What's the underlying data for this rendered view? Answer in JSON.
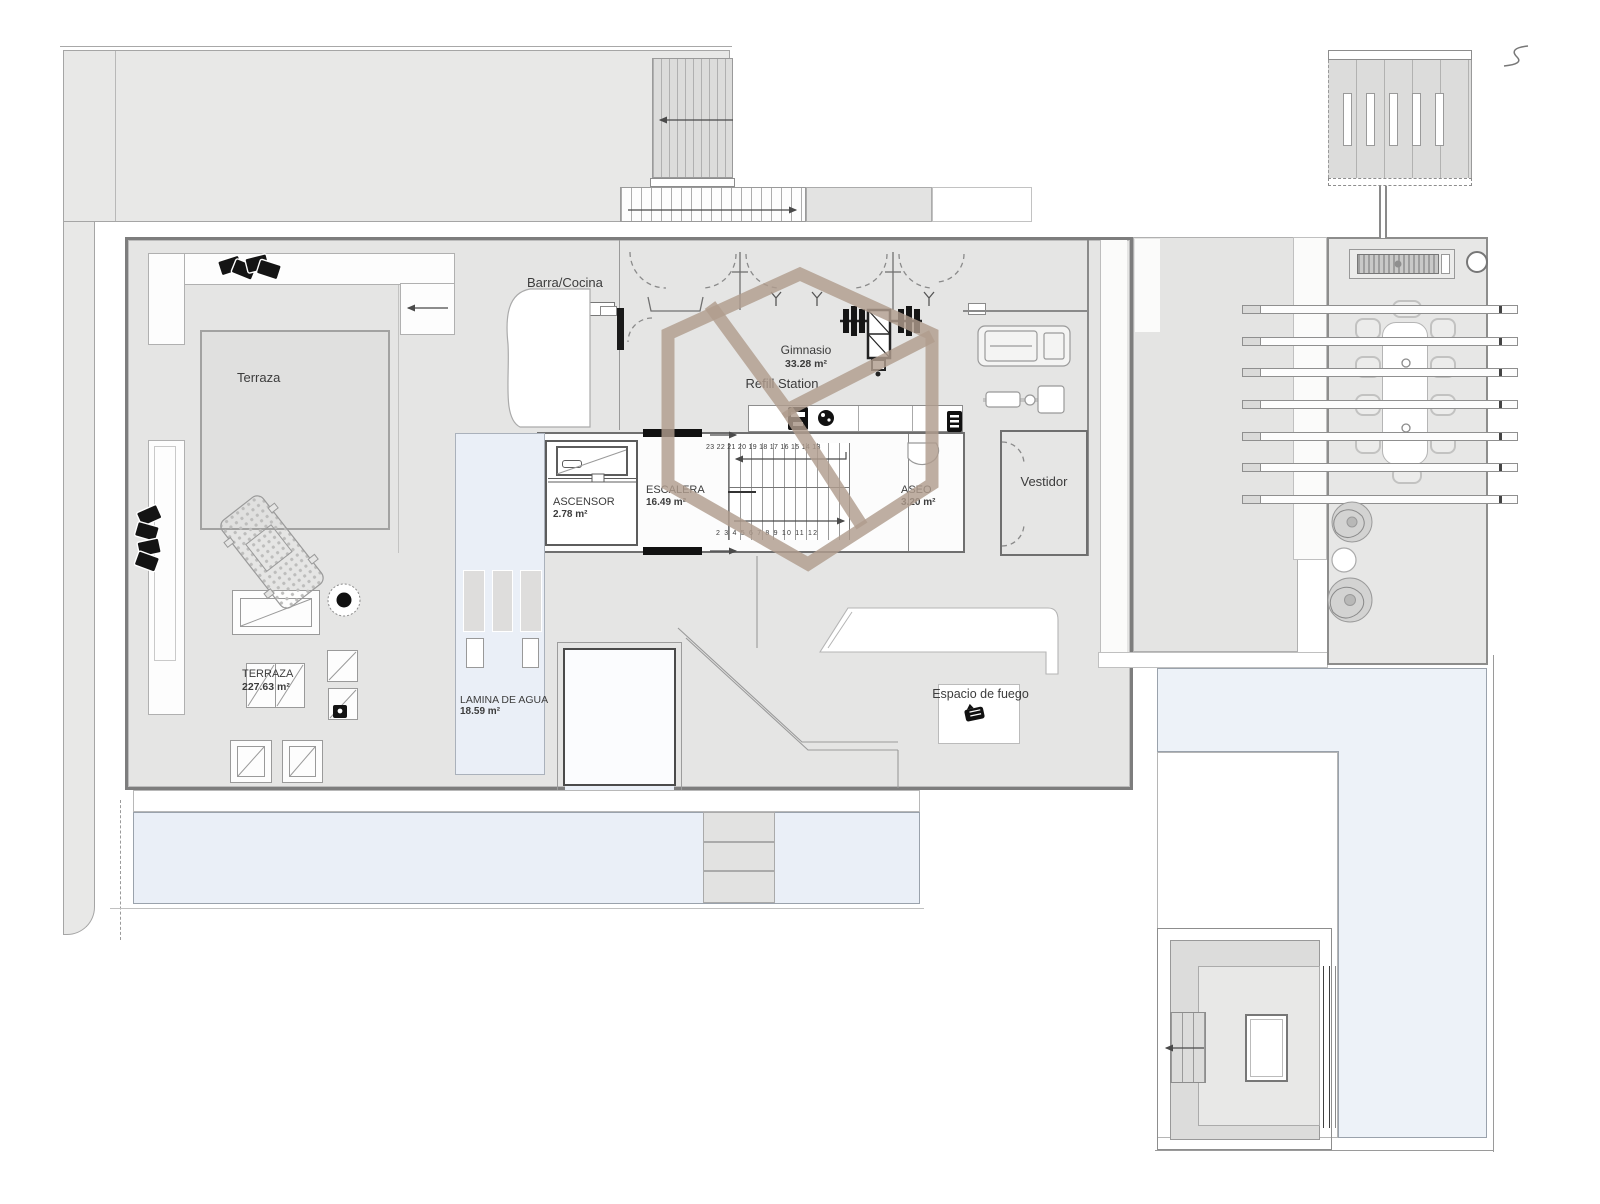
{
  "plan_title": "Penthouse terrace level floor plan",
  "labels": {
    "barra_cocina": "Barra/Cocina",
    "terraza": "Terraza",
    "gimnasio_name": "Gimnasio",
    "gimnasio_area": "33.28 m²",
    "refill_station": "Refill Station",
    "ascensor_name": "ASCENSOR",
    "ascensor_area": "2.78 m²",
    "escalera_name": "ESCALERA",
    "escalera_area": "16.49 m²",
    "aseo_name": "ASEO",
    "aseo_area": "3.20 m²",
    "vestidor": "Vestidor",
    "terraza_upper": "TERRAZA",
    "terraza_area": "227.63 m²",
    "lamina_name": "LAMINA DE AGUA",
    "lamina_area": "18.59 m²",
    "espacio_de_fuego": "Espacio de fuego"
  },
  "stairs": {
    "upper_run_numbers": "23 22 21 20 19 18 17 16 15 14 13",
    "lower_run_numbers": "2 3 4 5 6 7 8 9 10 11 12"
  },
  "colors": {
    "watermark_tan": "#b09c8d",
    "floor_gray": "#e5e5e4",
    "terrain_gray": "#e8e8e7",
    "water_feature_blue": "#eaeff7",
    "pool_blue": "#edf2f8",
    "wall_dark": "#7d7d7d",
    "plant_black": "#141414"
  }
}
